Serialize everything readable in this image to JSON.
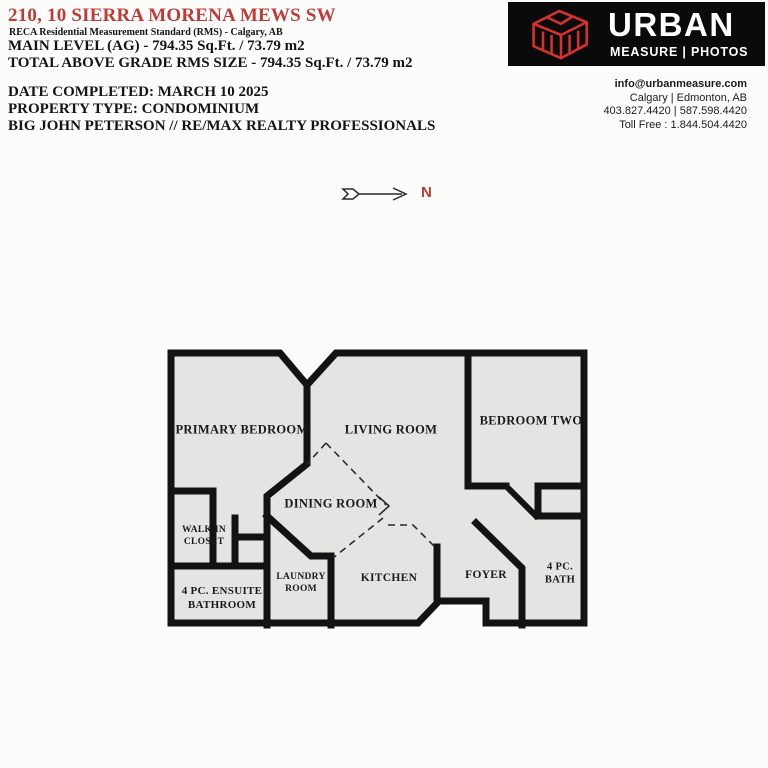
{
  "colors": {
    "accent_red": "#c23a36",
    "logo_red": "#d63030",
    "logo_bg": "#0a0a0a",
    "wall_black": "#131313",
    "floor_gray": "#e4e4e2",
    "page_bg": "#fcfcfb"
  },
  "header": {
    "address": "210, 10 SIERRA MORENA MEWS SW",
    "standard": "RECA Residential Measurement Standard (RMS) - Calgary, AB",
    "main_level": "MAIN LEVEL (AG) - 794.35 Sq.Ft. / 73.79 m2",
    "total_above_grade": "TOTAL ABOVE GRADE RMS SIZE - 794.35 Sq.Ft. / 73.79 m2",
    "date_completed": "DATE COMPLETED: MARCH 10 2025",
    "property_type": "PROPERTY TYPE: CONDOMINIUM",
    "agent": "BIG JOHN PETERSON // RE/MAX REALTY PROFESSIONALS"
  },
  "logo": {
    "brand": "URBAN",
    "subtitle": "MEASURE | PHOTOS"
  },
  "contact": {
    "email": "info@urbanmeasure.com",
    "cities": "Calgary | Edmonton, AB",
    "phones": "403.827.4420 | 587.598.4420",
    "toll_free": "Toll Free : 1.844.504.4420"
  },
  "compass": {
    "label": "N"
  },
  "floorplan": {
    "rooms": {
      "primary_bedroom": "PRIMARY BEDROOM",
      "living_room": "LIVING ROOM",
      "bedroom_two": "BEDROOM TWO",
      "dining_room": "DINING ROOM",
      "walk_in_closet_line1": "WALK IN",
      "walk_in_closet_line2": "CLOSET",
      "ensuite_line1": "4 PC. ENSUITE",
      "ensuite_line2": "BATHROOM",
      "laundry_line1": "LAUNDRY",
      "laundry_line2": "ROOM",
      "kitchen": "KITCHEN",
      "foyer": "FOYER",
      "bath_line1": "4 PC.",
      "bath_line2": "BATH"
    }
  }
}
